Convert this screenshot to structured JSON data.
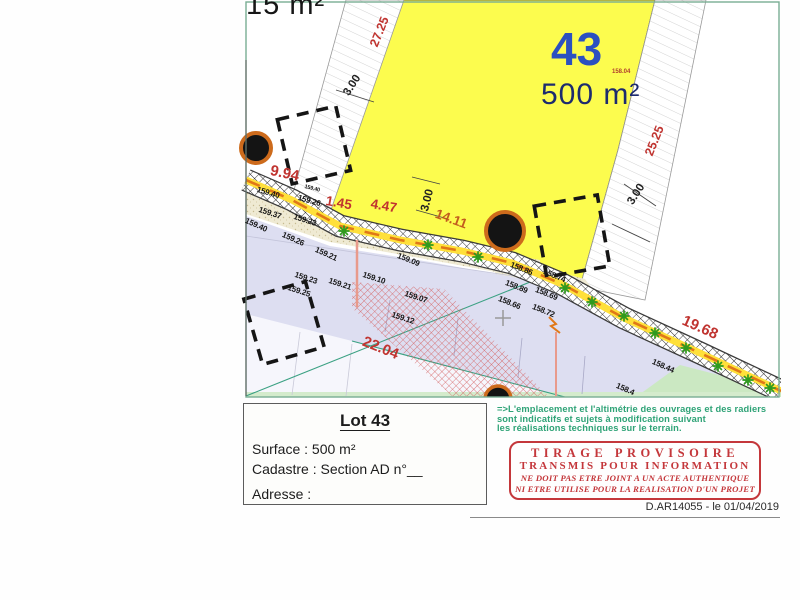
{
  "plan": {
    "corner_label": "15 m²",
    "parcel": {
      "number": "43",
      "area": "500 m²",
      "spot_elevation": "158.04"
    },
    "dimensions": [
      "27.25",
      "3.00",
      "9.94",
      "1.45",
      "4.47",
      "3.00",
      "14.11",
      "25.25",
      "3.00",
      "19.68",
      "22.04"
    ],
    "elevations": [
      "159.40",
      "159.26",
      "159.40",
      "159.37",
      "159.23",
      "159.40",
      "159.26",
      "159.21",
      "159.23",
      "159.21",
      "159.25",
      "159.10",
      "159.09",
      "159.07",
      "159.12",
      "158.86",
      "158.74",
      "158.89",
      "158.69",
      "158.66",
      "158.72",
      "158.44",
      "158.4"
    ]
  },
  "title_block": {
    "lot_title": "Lot 43",
    "surface": "Surface : 500 m²",
    "cadastre": "Cadastre : Section AD n°__",
    "adresse": "Adresse :"
  },
  "note": {
    "line1": "=>L'emplacement et l'altimétrie des ouvrages et des radiers",
    "line2": "sont indicatifs et sujets à modification suivant",
    "line3": "les réalisations techniques sur le terrain."
  },
  "stamp": {
    "line1": "TIRAGE PROVISOIRE",
    "line2": "TRANSMIS POUR INFORMATION",
    "line3": "NE DOIT PAS ETRE JOINT A UN ACTE AUTHENTIQUE",
    "line4": "NI ETRE UTILISE POUR LA REALISATION D'UN PROJET"
  },
  "footer": {
    "reference": "D.AR14055 - le 01/04/2019"
  },
  "colors": {
    "parcel_yellow": "#fcfc4e",
    "dimension_red": "#c03430",
    "parcel_number_blue": "#2b50c0",
    "road_lavender": "#dddef1",
    "pipe_yellow": "#ffe03a",
    "pipe_orange": "#e07818",
    "tree_green": "#2f9a1e",
    "note_green": "#2fa377",
    "stamp_red": "#c4373b"
  }
}
